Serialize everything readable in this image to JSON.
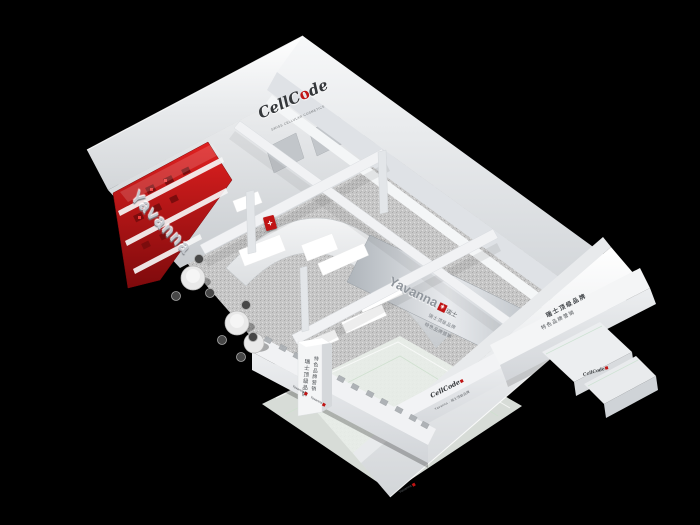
{
  "scene": {
    "background": "#000000",
    "note": "Aerial 3D render of a white island exhibition booth with red product displays"
  },
  "brand": {
    "cellcode_pre": "CellC",
    "cellcode_accent": "o",
    "cellcode_post": "de",
    "cellcode_tagline": "SWISS CELLULAR COSMETICS",
    "yavanna": "Yavanna",
    "cross": "+",
    "suffix_cn": "瑞士"
  },
  "labels": {
    "wall_letters": "Yavanna",
    "panel_name": "Yavanna",
    "panel_line_1": "瑞士顶级品牌",
    "panel_line_2": "特色品牌营销",
    "rightwall_line_1": "瑞士顶级品牌",
    "rightwall_line_2": "特色品牌营销",
    "pillar_col_1": "瑞士顶级品牌",
    "pillar_col_2": "特色品牌营销",
    "fascia_logo": "CellCode",
    "fascia_sub": "Yavanna · 瑞士顶级品牌",
    "edge_label_1": "Yavanna",
    "edge_label_2": "Yavanna",
    "corner_label": "Yavanna",
    "counter_logo": "CellCode"
  },
  "colors": {
    "accent_red": "#c01414",
    "booth_white": "#f2f3f4",
    "carpet_gray": "#c8c8c8",
    "glass_green": "#e9efe9"
  }
}
